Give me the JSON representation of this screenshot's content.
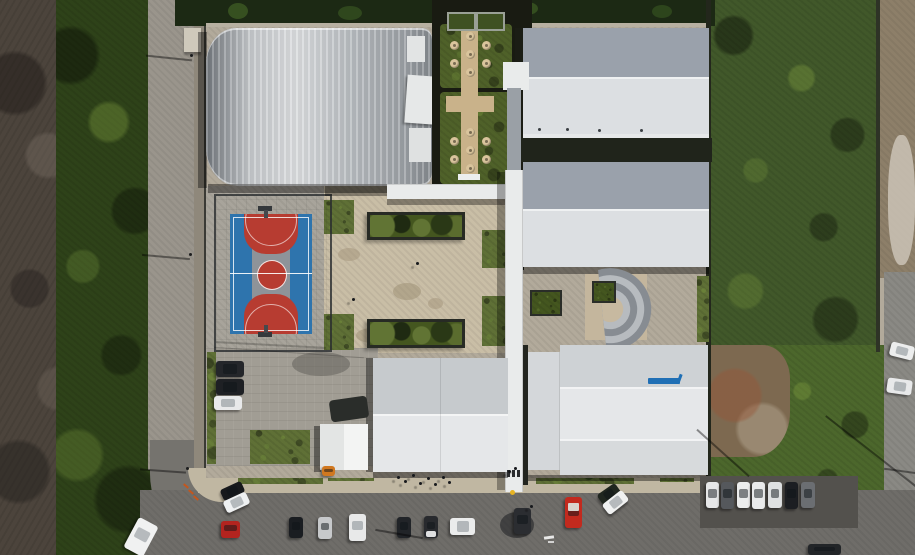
{
  "meta": {
    "type": "aerial-drone-photo",
    "subject": "sports and education campus seen from directly above, surrounded by scrubland, tree lines, dirt and paved roads with parked cars",
    "width_px": 915,
    "height_px": 555
  },
  "palette": {
    "scrubland": "#4c443c",
    "trees_dark": "#2e4219",
    "field_east": "#41582a",
    "field_east_south": "#4c672c",
    "dirt_ne": "#8d7f69",
    "dirt_patch_se": "#7d6950",
    "dirt_road_west": "#9a958c",
    "asphalt_curve": "#75736e",
    "street_asphalt": "#6f6d69",
    "sidewalk": "#c0b7a2",
    "road_east": "#8a8984",
    "campus_concrete": "#b2aa9b",
    "plaza_concrete": "#c9bea6",
    "court_apron": "#a8a49b",
    "paver_lot": "#a19d94",
    "dark_lot_pad": "#53514d",
    "gym_roof_base": "#b4b8bc",
    "roof_slope_dark": "#9aa1ab",
    "roof_slope_light": "#dcdfe2",
    "roof_band_top": "#ced2d5",
    "roof_band_mid": "#e5e7e9",
    "roof_band_low": "#d7dadc",
    "walkway_white": "#e9ebeb",
    "tent_white": "#f3f4f3",
    "green_roof_membrane": "#191b12",
    "green_roof_grass": "#4f6129",
    "garden_path": "#c9b28a",
    "picnic_table": "#d9c49c",
    "planter_green": "#44561f",
    "grass_patch": "#5f7036",
    "court_blue": "#2e74ad",
    "court_red": "#b73c31",
    "court_gray": "#8e9399",
    "court_line": "#ffffff",
    "amphitheater_light": "#b7bbbf",
    "amphitheater_dark": "#878c92",
    "amphitheater_stage": "#c7b9a0",
    "roof_logo_blue": "#1f6fb5",
    "bollard_yellow": "#e8b423",
    "utility_orange": "#d07820",
    "curb_orange": "#c2571f",
    "hedge_top": "#1c2914"
  },
  "scene": {
    "gymnasium": {
      "label": "large curved ribbed-metal roof gymnasium"
    },
    "basketball_court": {
      "label": "fenced outdoor basketball court",
      "blue": "#2e74ad",
      "red": "#b73c31",
      "center_band": "#8e9399"
    },
    "garden_roof": {
      "label": "green roof terrace",
      "picnic_clusters": 2,
      "tables_per_cluster": 7,
      "planter_boxes": 2
    },
    "plaza": {
      "label": "central concrete plaza",
      "sunken_planters": 2,
      "grass_patches": 4
    },
    "amphitheater": {
      "label": "semicircular stepped amphitheater",
      "rings": 4
    },
    "buildings_east": 2,
    "building_south": 1,
    "building_southeast": 1,
    "covered_walkway": {
      "label": "white covered walkway spine with street entrance"
    },
    "tent": {
      "label": "small white canopy tent"
    }
  },
  "vehicles": {
    "campus_lot": [
      {
        "color": "#24262a"
      },
      {
        "color": "#1e2024"
      },
      {
        "color": "#e8e9ea"
      }
    ],
    "street_corner": [
      {
        "color": "#17191c"
      },
      {
        "color": "#eef0f1"
      }
    ],
    "red_car": {
      "color": "#b3241f"
    },
    "street_row": [
      {
        "color": "#1a1d21"
      },
      {
        "color": "#c7c9cb"
      },
      {
        "color": "#e8e9e9"
      },
      {
        "color": "#212428"
      },
      {
        "color": "#282a2e"
      }
    ],
    "moving": [
      {
        "color": "#ebecec"
      },
      {
        "color": "#2b2d31"
      }
    ],
    "fire_truck": {
      "color": "#c22a1e"
    },
    "taxi_pair": [
      {
        "color": "#20261f"
      },
      {
        "color": "#f0f1f1"
      }
    ],
    "street_edge_car": {
      "color": "#222528"
    },
    "white_truck": {
      "color": "#f0f1f1"
    },
    "lot_east": [
      {
        "color": "#e6e7e8"
      },
      {
        "color": "#55585c"
      },
      {
        "color": "#eceded"
      },
      {
        "color": "#e9eaeb"
      },
      {
        "color": "#dfe1e2"
      },
      {
        "color": "#1c1e22"
      },
      {
        "color": "#6b6e72"
      }
    ],
    "road_east": [
      {
        "color": "#eceded"
      },
      {
        "color": "#e8e9ea"
      }
    ],
    "utility_vehicle": {
      "color": "#d07820"
    }
  }
}
